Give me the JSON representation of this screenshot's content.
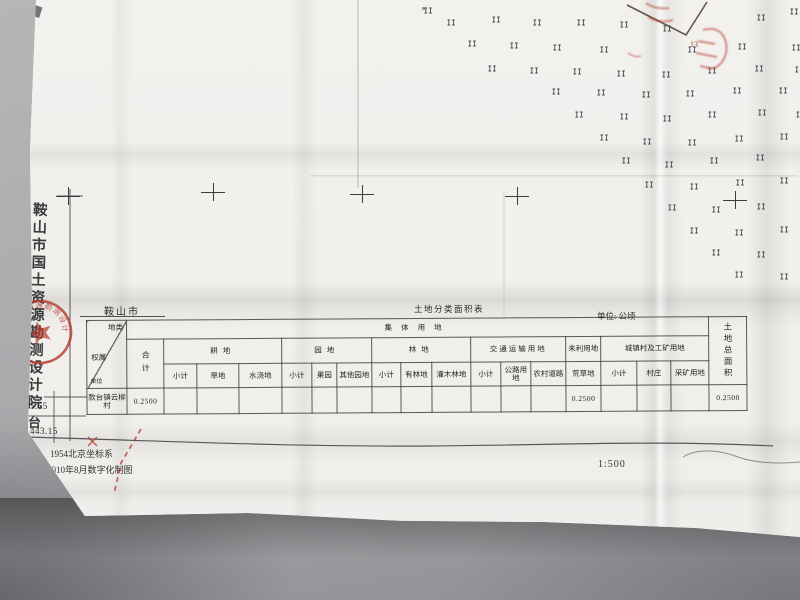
{
  "margin": {
    "institute": "鞍山市国土资源勘测设计院",
    "institute_extra": "台",
    "grid_y_label": "4575.65",
    "grid_x_label": "443.15"
  },
  "seal": {
    "ring_text": "鞍山市国土资源勘测设计院",
    "color": "#b5372a"
  },
  "map_area": {
    "grass_symbol": "II",
    "vertex_label": "13",
    "crosses": [
      [
        68,
        196
      ],
      [
        213,
        192
      ],
      [
        362,
        194
      ],
      [
        517,
        196
      ],
      [
        735,
        200
      ]
    ],
    "grass_positions": [
      [
        424,
        8
      ],
      [
        447,
        20
      ],
      [
        492,
        17
      ],
      [
        533,
        20
      ],
      [
        577,
        20
      ],
      [
        620,
        22
      ],
      [
        663,
        26
      ],
      [
        757,
        15
      ],
      [
        790,
        9
      ],
      [
        468,
        41
      ],
      [
        510,
        43
      ],
      [
        553,
        45
      ],
      [
        600,
        47
      ],
      [
        688,
        47
      ],
      [
        738,
        44
      ],
      [
        792,
        45
      ],
      [
        488,
        66
      ],
      [
        530,
        68
      ],
      [
        573,
        69
      ],
      [
        617,
        71
      ],
      [
        662,
        72
      ],
      [
        708,
        68
      ],
      [
        755,
        66
      ],
      [
        795,
        67
      ],
      [
        552,
        89
      ],
      [
        597,
        90
      ],
      [
        642,
        92
      ],
      [
        686,
        91
      ],
      [
        733,
        88
      ],
      [
        779,
        88
      ],
      [
        575,
        112
      ],
      [
        620,
        114
      ],
      [
        663,
        116
      ],
      [
        708,
        112
      ],
      [
        758,
        110
      ],
      [
        796,
        112
      ],
      [
        600,
        135
      ],
      [
        643,
        139
      ],
      [
        688,
        140
      ],
      [
        735,
        136
      ],
      [
        780,
        134
      ],
      [
        622,
        158
      ],
      [
        665,
        162
      ],
      [
        710,
        158
      ],
      [
        756,
        155
      ],
      [
        645,
        182
      ],
      [
        690,
        184
      ],
      [
        736,
        180
      ],
      [
        780,
        178
      ],
      [
        668,
        205
      ],
      [
        712,
        207
      ],
      [
        757,
        204
      ],
      [
        690,
        228
      ],
      [
        735,
        230
      ],
      [
        780,
        227
      ],
      [
        712,
        250
      ],
      [
        757,
        252
      ],
      [
        735,
        272
      ],
      [
        780,
        274
      ]
    ]
  },
  "table_area": {
    "region_label": "鞍山市",
    "title": "土地分类面积表",
    "unit_label": "单位: 公顷",
    "corner": {
      "top_right": "地类",
      "left": "权属",
      "bottom_left": "单位"
    },
    "header1": {
      "collective": "集体用地",
      "total": "土地总面积"
    },
    "header2": [
      "合计",
      "耕地",
      "园地",
      "林地",
      "交通运输用地",
      "未利用地",
      "城镇村及工矿用地"
    ],
    "header3": [
      "小计",
      "旱地",
      "水浇地",
      "小计",
      "果园",
      "其他园地",
      "小计",
      "有林地",
      "灌木林地",
      "小计",
      "公路用地",
      "农村道路",
      "荒草地",
      "小计",
      "村庄",
      "采矿用地"
    ],
    "row": {
      "owner": "款台镇云柳村",
      "values": [
        "0.2500",
        "",
        "",
        "",
        "",
        "",
        "",
        "",
        "",
        "",
        "",
        "",
        "",
        "0.2500",
        "",
        "",
        "",
        "0.2500"
      ]
    }
  },
  "footer": {
    "coordinate_system": "1954北京坐标系",
    "production_note": "2010年8月数字化制图",
    "scale": "1:500"
  }
}
